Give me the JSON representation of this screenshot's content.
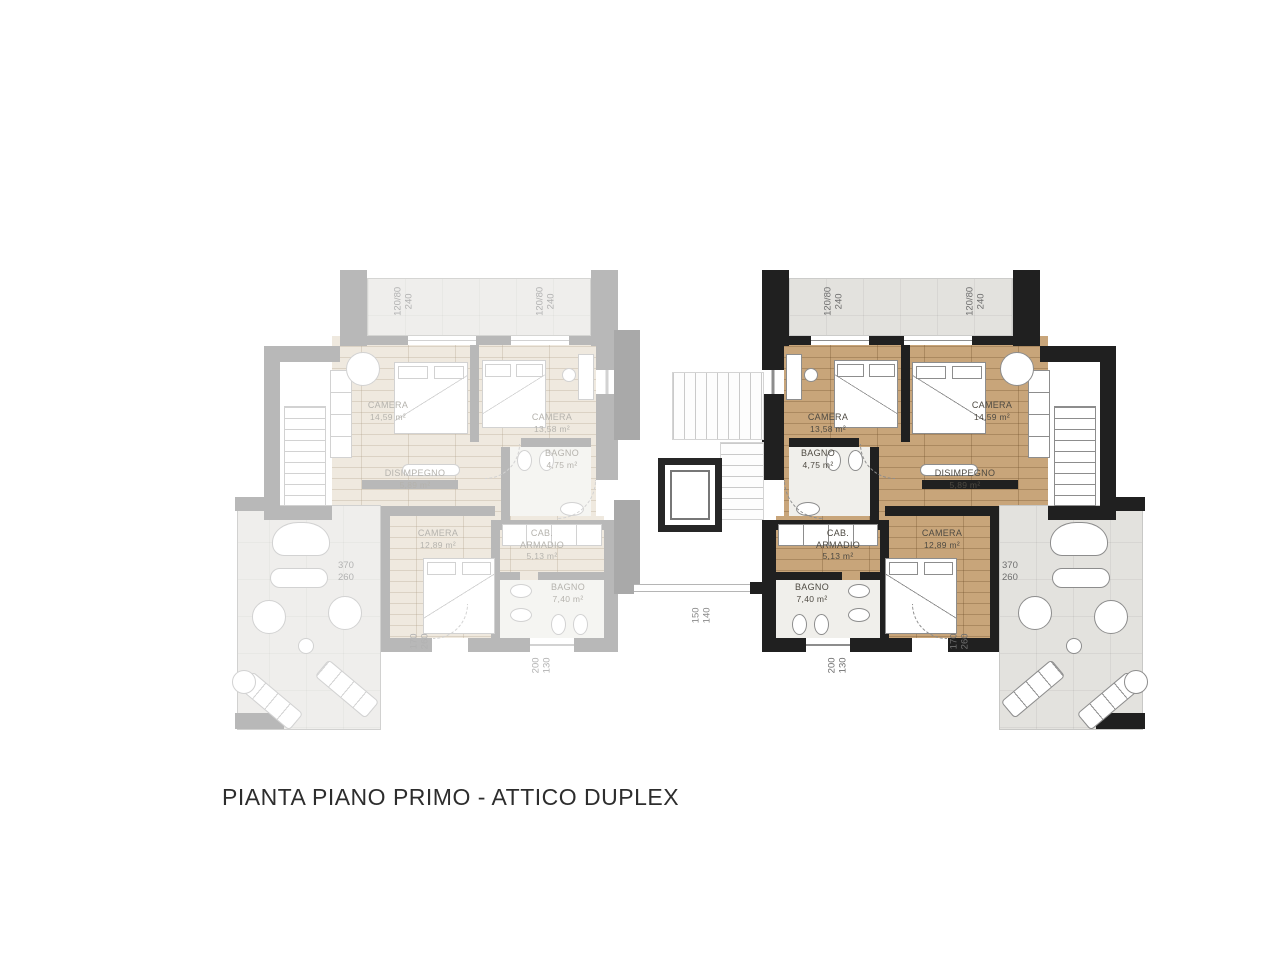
{
  "title": "PIANTA PIANO PRIMO - ATTICO DUPLEX",
  "colors": {
    "active_wall": "#202020",
    "active_wood_floor": "#c8a57a",
    "inactive_wall": "#a9a9a9",
    "inactive_wood_floor": "#ece5d9",
    "terrace_tile": "#e3e2de",
    "background": "#ffffff"
  },
  "unit": {
    "camera_inner": {
      "name": "CAMERA",
      "area": "13,58 m²"
    },
    "camera_outer": {
      "name": "CAMERA",
      "area": "14,59 m²"
    },
    "bagno_small": {
      "name": "BAGNO",
      "area": "4,75 m²"
    },
    "disimpegno": {
      "name": "DISIMPEGNO",
      "area": "5,89 m²"
    },
    "cab_armadio": {
      "name": "CAB. ARMADIO",
      "area": "5,13 m²"
    },
    "camera_lower": {
      "name": "CAMERA",
      "area": "12,89 m²"
    },
    "bagno_big": {
      "name": "BAGNO",
      "area": "7,40 m²"
    },
    "window_dim": {
      "size": "120/80",
      "height": "240"
    },
    "dim_terrace": {
      "w": "370",
      "h": "260"
    },
    "dim_terrace_side": {
      "w": "170",
      "h": "260"
    },
    "dim_lower_window": {
      "w": "200",
      "h": "130"
    }
  },
  "core": {
    "dim_landing": {
      "w": "150",
      "h": "140"
    }
  }
}
